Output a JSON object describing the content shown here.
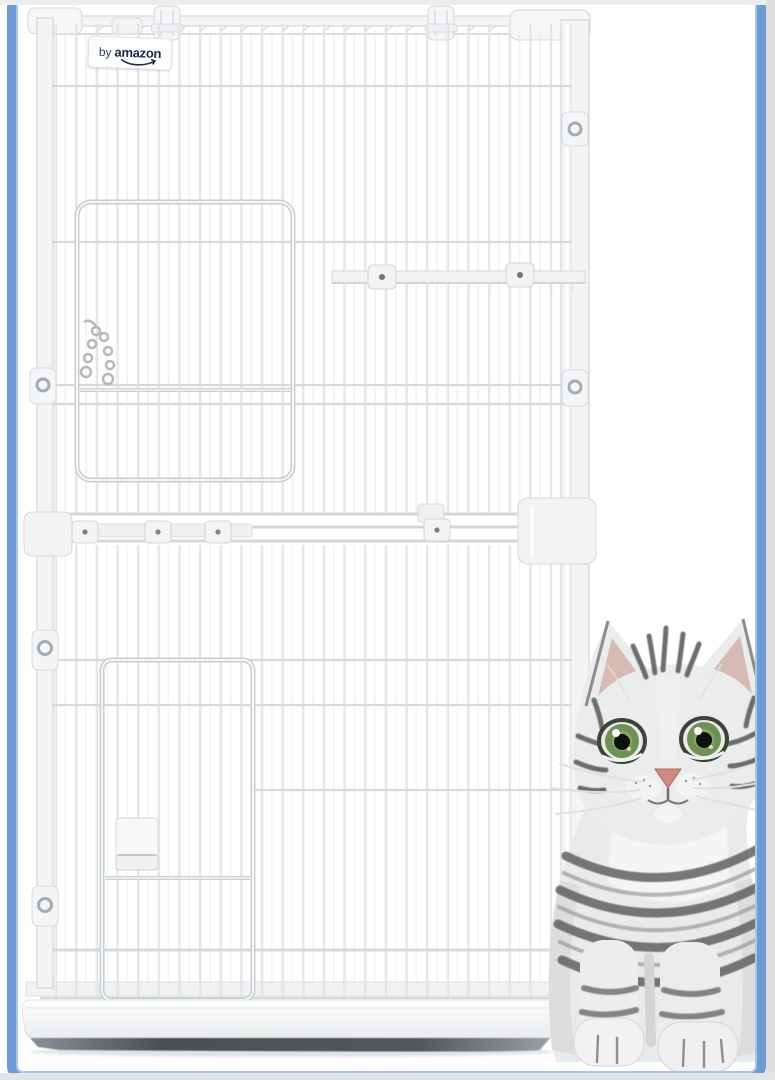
{
  "image": {
    "type": "product-photo",
    "subject": "Two-tier white wire cat cage with front doors, platform shelf, slide-out base tray, and a silver tabby cat with green eyes sitting beside it",
    "background": "#ffffff"
  },
  "badge": {
    "prefix": "by",
    "brand": "amazon",
    "text_color": "#1b2b47",
    "bg": "#fdfdfe"
  },
  "frame": {
    "border_color": "#6e9bd3",
    "inner_highlight": "#a9c6e8",
    "outer_strip_color": "#e2e3e5"
  },
  "cage": {
    "wire_color": "#d8dce0",
    "plastic_color": "#f3f4f6",
    "tray_base_color": "#4a4f54",
    "doors": 2,
    "tiers": 2
  },
  "cat": {
    "fur_light": "#ebecec",
    "stripe": "#5c5c5c",
    "eye_green": "#6e9157",
    "eye_inner_green": "#8fae74",
    "nose_pink": "#cd8a82",
    "ear_inner": "#d6b5af"
  }
}
